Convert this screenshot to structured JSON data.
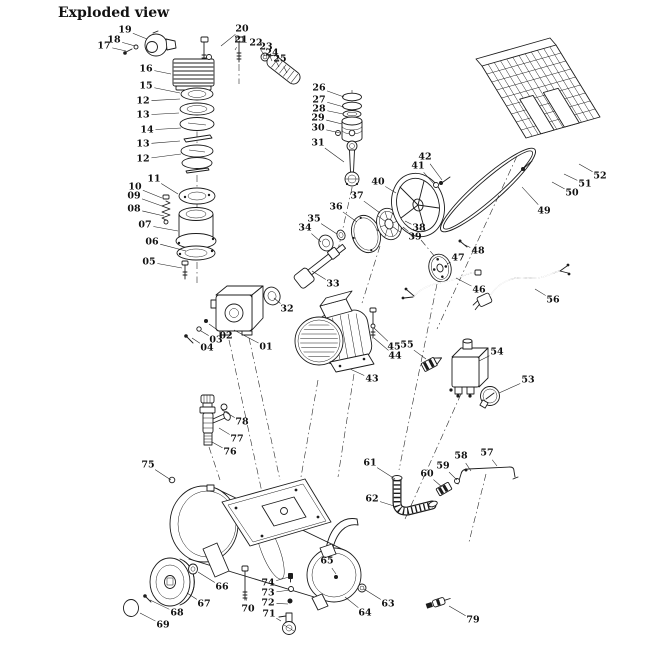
{
  "title": "Exploded view",
  "colors": {
    "background": "#ffffff",
    "ink": "#1c1c1c"
  },
  "diagram": {
    "type": "exploded-parts-diagram",
    "subject": "belt-driven air compressor",
    "labels": [
      {
        "n": "19",
        "x": 125,
        "y": 30,
        "tx": 147,
        "ty": 39
      },
      {
        "n": "18",
        "x": 114,
        "y": 40,
        "tx": 135,
        "ty": 46
      },
      {
        "n": "17",
        "x": 104,
        "y": 46,
        "tx": 126,
        "ty": 51
      },
      {
        "n": "16",
        "x": 146,
        "y": 69,
        "tx": 171,
        "ty": 74
      },
      {
        "n": "15",
        "x": 146,
        "y": 86,
        "tx": 180,
        "ty": 93
      },
      {
        "n": "12",
        "x": 143,
        "y": 101,
        "tx": 180,
        "ty": 99
      },
      {
        "n": "13",
        "x": 143,
        "y": 115,
        "tx": 179,
        "ty": 113
      },
      {
        "n": "14",
        "x": 147,
        "y": 130,
        "tx": 181,
        "ty": 128
      },
      {
        "n": "13",
        "x": 143,
        "y": 144,
        "tx": 180,
        "ty": 141
      },
      {
        "n": "12",
        "x": 143,
        "y": 159,
        "tx": 181,
        "ty": 154
      },
      {
        "n": "20",
        "x": 242,
        "y": 29,
        "tx": 221,
        "ty": 46
      },
      {
        "n": "21",
        "x": 241,
        "y": 40,
        "tx": 235,
        "ty": 50
      },
      {
        "n": "22",
        "x": 256,
        "y": 43,
        "tx": 265,
        "ty": 56
      },
      {
        "n": "23",
        "x": 266,
        "y": 47,
        "tx": 272,
        "ty": 61
      },
      {
        "n": "24",
        "x": 272,
        "y": 53,
        "tx": 279,
        "ty": 67
      },
      {
        "n": "25",
        "x": 280,
        "y": 59,
        "tx": 287,
        "ty": 73
      },
      {
        "n": "26",
        "x": 319,
        "y": 88,
        "tx": 344,
        "ty": 97
      },
      {
        "n": "27",
        "x": 319,
        "y": 100,
        "tx": 344,
        "ty": 107
      },
      {
        "n": "28",
        "x": 319,
        "y": 109,
        "tx": 343,
        "ty": 114
      },
      {
        "n": "29",
        "x": 318,
        "y": 118,
        "tx": 342,
        "ty": 124
      },
      {
        "n": "30",
        "x": 318,
        "y": 128,
        "tx": 340,
        "ty": 133
      },
      {
        "n": "31",
        "x": 318,
        "y": 143,
        "tx": 344,
        "ty": 162
      },
      {
        "n": "10",
        "x": 135,
        "y": 187,
        "tx": 162,
        "ty": 198
      },
      {
        "n": "09",
        "x": 134,
        "y": 196,
        "tx": 162,
        "ty": 206
      },
      {
        "n": "08",
        "x": 134,
        "y": 209,
        "tx": 164,
        "ty": 216
      },
      {
        "n": "11",
        "x": 154,
        "y": 179,
        "tx": 178,
        "ty": 194
      },
      {
        "n": "07",
        "x": 145,
        "y": 225,
        "tx": 178,
        "ty": 231
      },
      {
        "n": "06",
        "x": 152,
        "y": 242,
        "tx": 186,
        "ty": 251
      },
      {
        "n": "05",
        "x": 149,
        "y": 262,
        "tx": 182,
        "ty": 268
      },
      {
        "n": "33",
        "x": 333,
        "y": 284,
        "tx": 312,
        "ty": 271
      },
      {
        "n": "34",
        "x": 305,
        "y": 228,
        "tx": 321,
        "ty": 242
      },
      {
        "n": "35",
        "x": 314,
        "y": 219,
        "tx": 337,
        "ty": 234
      },
      {
        "n": "36",
        "x": 336,
        "y": 207,
        "tx": 357,
        "ty": 222
      },
      {
        "n": "37",
        "x": 357,
        "y": 196,
        "tx": 380,
        "ty": 213
      },
      {
        "n": "38",
        "x": 419,
        "y": 228,
        "tx": 405,
        "ty": 221
      },
      {
        "n": "39",
        "x": 415,
        "y": 237,
        "tx": 403,
        "ty": 227
      },
      {
        "n": "40",
        "x": 378,
        "y": 182,
        "tx": 396,
        "ty": 193
      },
      {
        "n": "41",
        "x": 418,
        "y": 166,
        "tx": 434,
        "ty": 184
      },
      {
        "n": "42",
        "x": 425,
        "y": 157,
        "tx": 442,
        "ty": 180
      },
      {
        "n": "49",
        "x": 544,
        "y": 211,
        "tx": 522,
        "ty": 187
      },
      {
        "n": "50",
        "x": 572,
        "y": 193,
        "tx": 552,
        "ty": 182
      },
      {
        "n": "51",
        "x": 585,
        "y": 184,
        "tx": 564,
        "ty": 174
      },
      {
        "n": "52",
        "x": 600,
        "y": 176,
        "tx": 579,
        "ty": 164
      },
      {
        "n": "47",
        "x": 458,
        "y": 258,
        "tx": 447,
        "ty": 264
      },
      {
        "n": "48",
        "x": 478,
        "y": 251,
        "tx": 465,
        "ty": 245
      },
      {
        "n": "32",
        "x": 287,
        "y": 309,
        "tx": 274,
        "ty": 298
      },
      {
        "n": "01",
        "x": 266,
        "y": 347,
        "tx": 234,
        "ty": 330
      },
      {
        "n": "02",
        "x": 226,
        "y": 336,
        "tx": 209,
        "ty": 324
      },
      {
        "n": "03",
        "x": 216,
        "y": 340,
        "tx": 201,
        "ty": 331
      },
      {
        "n": "04",
        "x": 207,
        "y": 348,
        "tx": 192,
        "ty": 338
      },
      {
        "n": "43",
        "x": 372,
        "y": 379,
        "tx": 350,
        "ty": 369
      },
      {
        "n": "44",
        "x": 395,
        "y": 356,
        "tx": 374,
        "ty": 338
      },
      {
        "n": "45",
        "x": 394,
        "y": 347,
        "tx": 374,
        "ty": 328
      },
      {
        "n": "55",
        "x": 407,
        "y": 345,
        "tx": 426,
        "ty": 359
      },
      {
        "n": "54",
        "x": 497,
        "y": 352,
        "tx": 479,
        "ty": 361
      },
      {
        "n": "53",
        "x": 528,
        "y": 380,
        "tx": 499,
        "ty": 393
      },
      {
        "n": "46",
        "x": 479,
        "y": 290,
        "tx": 456,
        "ty": 278
      },
      {
        "n": "56",
        "x": 553,
        "y": 300,
        "tx": 535,
        "ty": 289
      },
      {
        "n": "57",
        "x": 487,
        "y": 453,
        "tx": 497,
        "ty": 466
      },
      {
        "n": "58",
        "x": 461,
        "y": 456,
        "tx": 471,
        "ty": 471
      },
      {
        "n": "59",
        "x": 443,
        "y": 466,
        "tx": 457,
        "ty": 480
      },
      {
        "n": "60",
        "x": 427,
        "y": 474,
        "tx": 442,
        "ty": 487
      },
      {
        "n": "61",
        "x": 370,
        "y": 463,
        "tx": 395,
        "ty": 479
      },
      {
        "n": "62",
        "x": 372,
        "y": 499,
        "tx": 394,
        "ty": 506
      },
      {
        "n": "63",
        "x": 388,
        "y": 604,
        "tx": 364,
        "ty": 589
      },
      {
        "n": "64",
        "x": 365,
        "y": 613,
        "tx": 345,
        "ty": 597
      },
      {
        "n": "65",
        "x": 327,
        "y": 561,
        "tx": 336,
        "ty": 574
      },
      {
        "n": "66",
        "x": 222,
        "y": 587,
        "tx": 198,
        "ty": 572
      },
      {
        "n": "67",
        "x": 204,
        "y": 604,
        "tx": 187,
        "ty": 593
      },
      {
        "n": "68",
        "x": 177,
        "y": 613,
        "tx": 150,
        "ty": 600
      },
      {
        "n": "69",
        "x": 163,
        "y": 625,
        "tx": 140,
        "ty": 613
      },
      {
        "n": "70",
        "x": 248,
        "y": 609,
        "tx": 246,
        "ty": 598
      },
      {
        "n": "71",
        "x": 269,
        "y": 614,
        "tx": 281,
        "ty": 621
      },
      {
        "n": "72",
        "x": 268,
        "y": 603,
        "tx": 288,
        "ty": 604
      },
      {
        "n": "73",
        "x": 268,
        "y": 593,
        "tx": 290,
        "ty": 590
      },
      {
        "n": "74",
        "x": 268,
        "y": 583,
        "tx": 289,
        "ty": 577
      },
      {
        "n": "75",
        "x": 148,
        "y": 465,
        "tx": 171,
        "ty": 480
      },
      {
        "n": "76",
        "x": 230,
        "y": 452,
        "tx": 212,
        "ty": 442
      },
      {
        "n": "77",
        "x": 237,
        "y": 439,
        "tx": 219,
        "ty": 428
      },
      {
        "n": "78",
        "x": 242,
        "y": 422,
        "tx": 222,
        "ty": 410
      },
      {
        "n": "79",
        "x": 473,
        "y": 620,
        "tx": 449,
        "ty": 606
      }
    ]
  }
}
